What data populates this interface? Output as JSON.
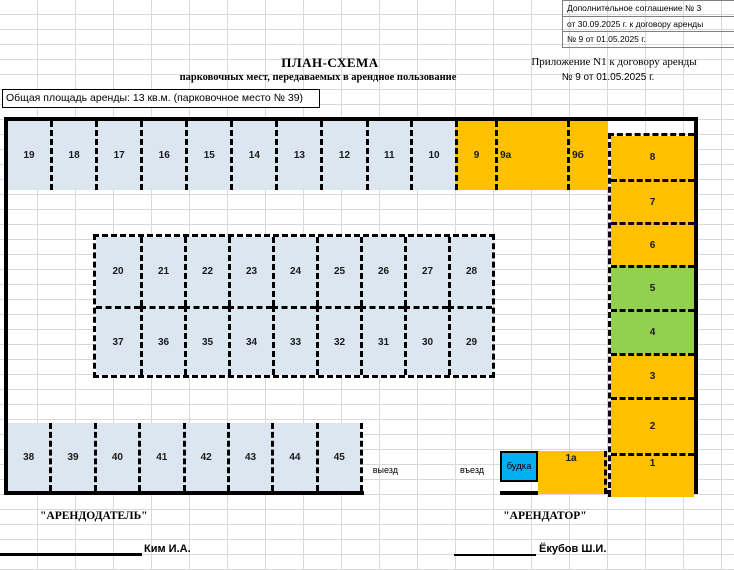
{
  "note_block": {
    "lines": [
      "Дополнительное соглашение № 3",
      "от 30.09.2025 г. к договору аренды",
      "№ 9 от 01.05.2025 г."
    ]
  },
  "header": {
    "title": "ПЛАН-СХЕМА",
    "subtitle": "парковочных мест, передаваемых в арендное пользование",
    "appendix_line1": "Приложение N1 к договору аренды",
    "appendix_line2": "№ 9 от 01.05.2025 г.",
    "area_note": "Общая площадь аренды: 13 кв.м. (парковочное место № 39)"
  },
  "colors": {
    "spot_blue": "#DCE6F1",
    "spot_orange": "#FFC000",
    "spot_green": "#92D050",
    "booth_blue": "#00B0F0",
    "grid_line": "#D9D9D9",
    "border_black": "#000000"
  },
  "lot": {
    "top_row_blue": [
      "19",
      "18",
      "17",
      "16",
      "15",
      "14",
      "13",
      "12",
      "11",
      "10"
    ],
    "top_row_orange": [
      {
        "label": "9",
        "w": 40,
        "align": "center"
      },
      {
        "label": "9а",
        "w": 72,
        "align": "left"
      },
      {
        "label": "9б",
        "w": 41,
        "align": "left"
      }
    ],
    "middle_row_top": [
      "20",
      "21",
      "22",
      "23",
      "24",
      "25",
      "26",
      "27",
      "28"
    ],
    "middle_row_bottom": [
      "37",
      "36",
      "35",
      "34",
      "33",
      "32",
      "31",
      "30",
      "29"
    ],
    "bottom_row": [
      "38",
      "39",
      "40",
      "41",
      "42",
      "43",
      "44",
      "45"
    ],
    "right_column": [
      {
        "label": "8",
        "color": "orange",
        "h": 43
      },
      {
        "label": "7",
        "color": "orange",
        "h": 43
      },
      {
        "label": "6",
        "color": "orange",
        "h": 43
      },
      {
        "label": "5",
        "color": "green",
        "h": 44
      },
      {
        "label": "4",
        "color": "green",
        "h": 44
      },
      {
        "label": "3",
        "color": "orange",
        "h": 44
      },
      {
        "label": "2",
        "color": "orange",
        "h": 56
      },
      {
        "label": "1",
        "color": "orange",
        "h": 44,
        "labelPos": "top"
      }
    ],
    "booth_label": "будка",
    "spot_1a_label": "1а",
    "exit_label": "выезд",
    "entrance_label": "въезд"
  },
  "signatures": {
    "landlord_title": "\"АРЕНДОДАТЕЛЬ\"",
    "landlord_name": "Ким И.А.",
    "tenant_title": "\"АРЕНДАТОР\"",
    "tenant_name": "Ёкубов Ш.И."
  }
}
